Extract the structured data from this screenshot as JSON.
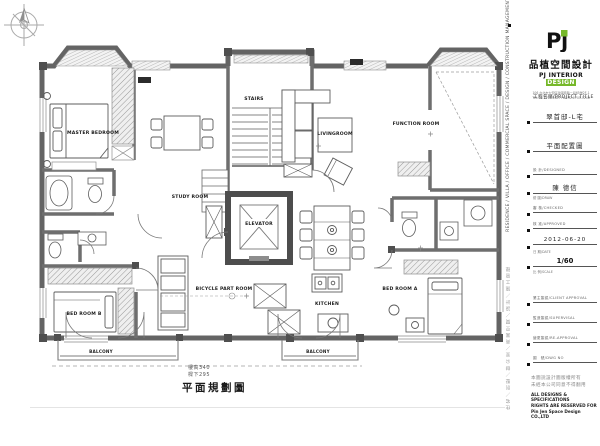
{
  "logo": {
    "mark": "Pj",
    "company_cn": "品植空間設計",
    "company_en_left": "PJ INTERIOR ",
    "company_en_accent": "DESIGN",
    "address": "106 台北市大安區建國南路二段65號2F-1",
    "contact": "TEL:02-2705-5687 FAX:02-2705-5248",
    "accent_color": "#76b82a"
  },
  "sidebar": {
    "vertical_en": "RESIDENCE / VILLA / OFFICE / COMMERCIAL SPACE / DESIGN / CONSTRUCTION MANAGEMENT (C.M)",
    "vertical_cn": "住宅／別墅／辦公室／商業空間／設計／施工管理"
  },
  "titleblock": {
    "project_label": "工程名稱/PROJECT  TITLE",
    "project_name": "翠首邸-L宅",
    "drawing_name": "平面配置圖",
    "design_label": "設 計/DESIGNED",
    "designer_name": "陳 德信",
    "draw_label": "繪 圖/DRAW",
    "check_label": "審 核/CHECKED",
    "approve_label": "核 准/APPROVED",
    "date": "2012-06-20",
    "date_label": "日 期/DATE",
    "scale": "1/60",
    "scale_label": "比 例/SCALE",
    "sign_rows": [
      {
        "label": "業主簽認/CLIENT  APPROVAL"
      },
      {
        "label": "監造簽認/SUPERVISAL"
      },
      {
        "label": "變更簽認/RE-APPROVAL"
      },
      {
        "label": "圖　號/DWG  NO"
      }
    ],
    "copyright_cn_1": "本圖說設計圖版權所有",
    "copyright_cn_2": "未經本公司同意不得翻用",
    "copyright_en_1": "ALL DESIGNS & SPECIFICATIONS",
    "copyright_en_2": "RIGHTS ARE RESERVED FOR",
    "copyright_en_3": "Pin Jen  Space Design CO.,LTD"
  },
  "floorplan": {
    "rooms": [
      {
        "label": "MASTER BEDROOM"
      },
      {
        "label": "STUDY ROOM"
      },
      {
        "label": "STAIRS"
      },
      {
        "label": "LIVINGROOM"
      },
      {
        "label": "FUNCTION ROOM"
      },
      {
        "label": "ELEVATOR"
      },
      {
        "label": "BICYCLE PART ROOM"
      },
      {
        "label": "KITCHEN"
      },
      {
        "label": "BED ROOM A"
      },
      {
        "label": "BED ROOM B"
      },
      {
        "label": "BALCONY"
      },
      {
        "label": "BALCONY"
      }
    ]
  },
  "footer": {
    "height_note": "樓高340",
    "beam_note": "樑下295",
    "drawing_title": "平面規劃圖"
  }
}
